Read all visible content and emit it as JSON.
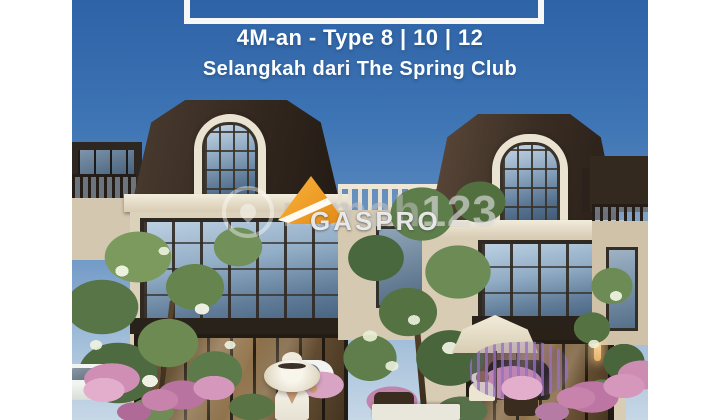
{
  "hero": {
    "headline_line1": "4M-an - Type 8 | 10 | 12",
    "headline_line2": "Selangkah dari The Spring Club"
  },
  "watermarks": {
    "rumah123": {
      "prefix": "rumah",
      "suffix": "123"
    },
    "gaspro": {
      "label": "GASPRO"
    }
  },
  "colors": {
    "canvas_bg": "#ffffff",
    "sky_top": "#2e63a7",
    "sky_horizon": "#c6d7e6",
    "headline_text": "#fdfefe",
    "frame_white": "#f7f8f6",
    "roof_brown": "#33281f",
    "wall_cream": "#dcd1ba",
    "trim_white": "#f2ecdc",
    "gaspro_orange": "#ee9c26",
    "flower_pink": "#cf8fb4",
    "flower_lavender": "#9672be",
    "foliage_green": "#5d7d4a",
    "watermark_white": "rgba(255,255,255,0.45)"
  }
}
